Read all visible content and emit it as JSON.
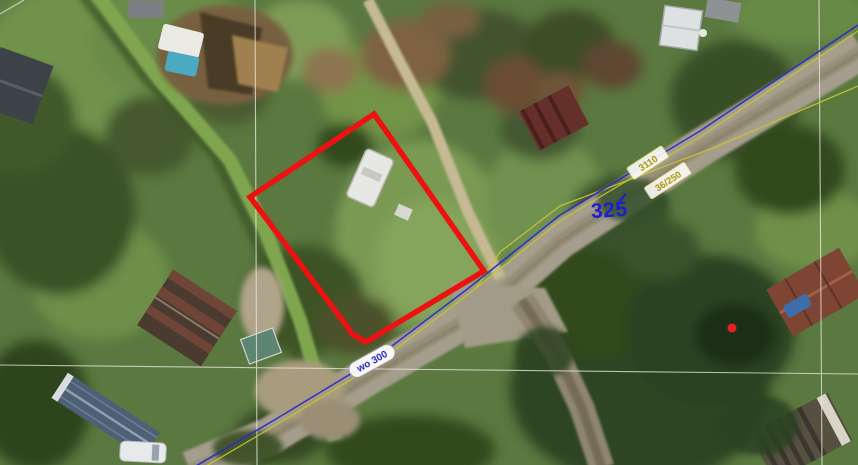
{
  "map": {
    "view_type": "aerial-orthophoto-with-cadastral-overlay",
    "parcel_outline": {
      "color": "#ee1111",
      "stroke_width": 5.5,
      "vertices": [
        [
          374,
          114
        ],
        [
          484,
          271
        ],
        [
          366,
          342
        ],
        [
          352,
          334
        ],
        [
          346,
          325
        ],
        [
          250,
          197
        ]
      ]
    },
    "point_marker": {
      "color": "#e62020",
      "x": 732,
      "y": 328,
      "radius": 4.5
    },
    "labels": {
      "distance": {
        "text": "325",
        "color": "#1d1dd6"
      },
      "parcel_a": {
        "text": "3110",
        "color": "#ab9703"
      },
      "parcel_b": {
        "text": "36/250",
        "color": "#ab9703"
      },
      "road": {
        "text": "wo 300",
        "color": "#2a2ad0"
      }
    },
    "line_colors": {
      "road_axis": "#2a2acc",
      "utility": "#c9c431",
      "cadastral": "#eceae2"
    }
  }
}
